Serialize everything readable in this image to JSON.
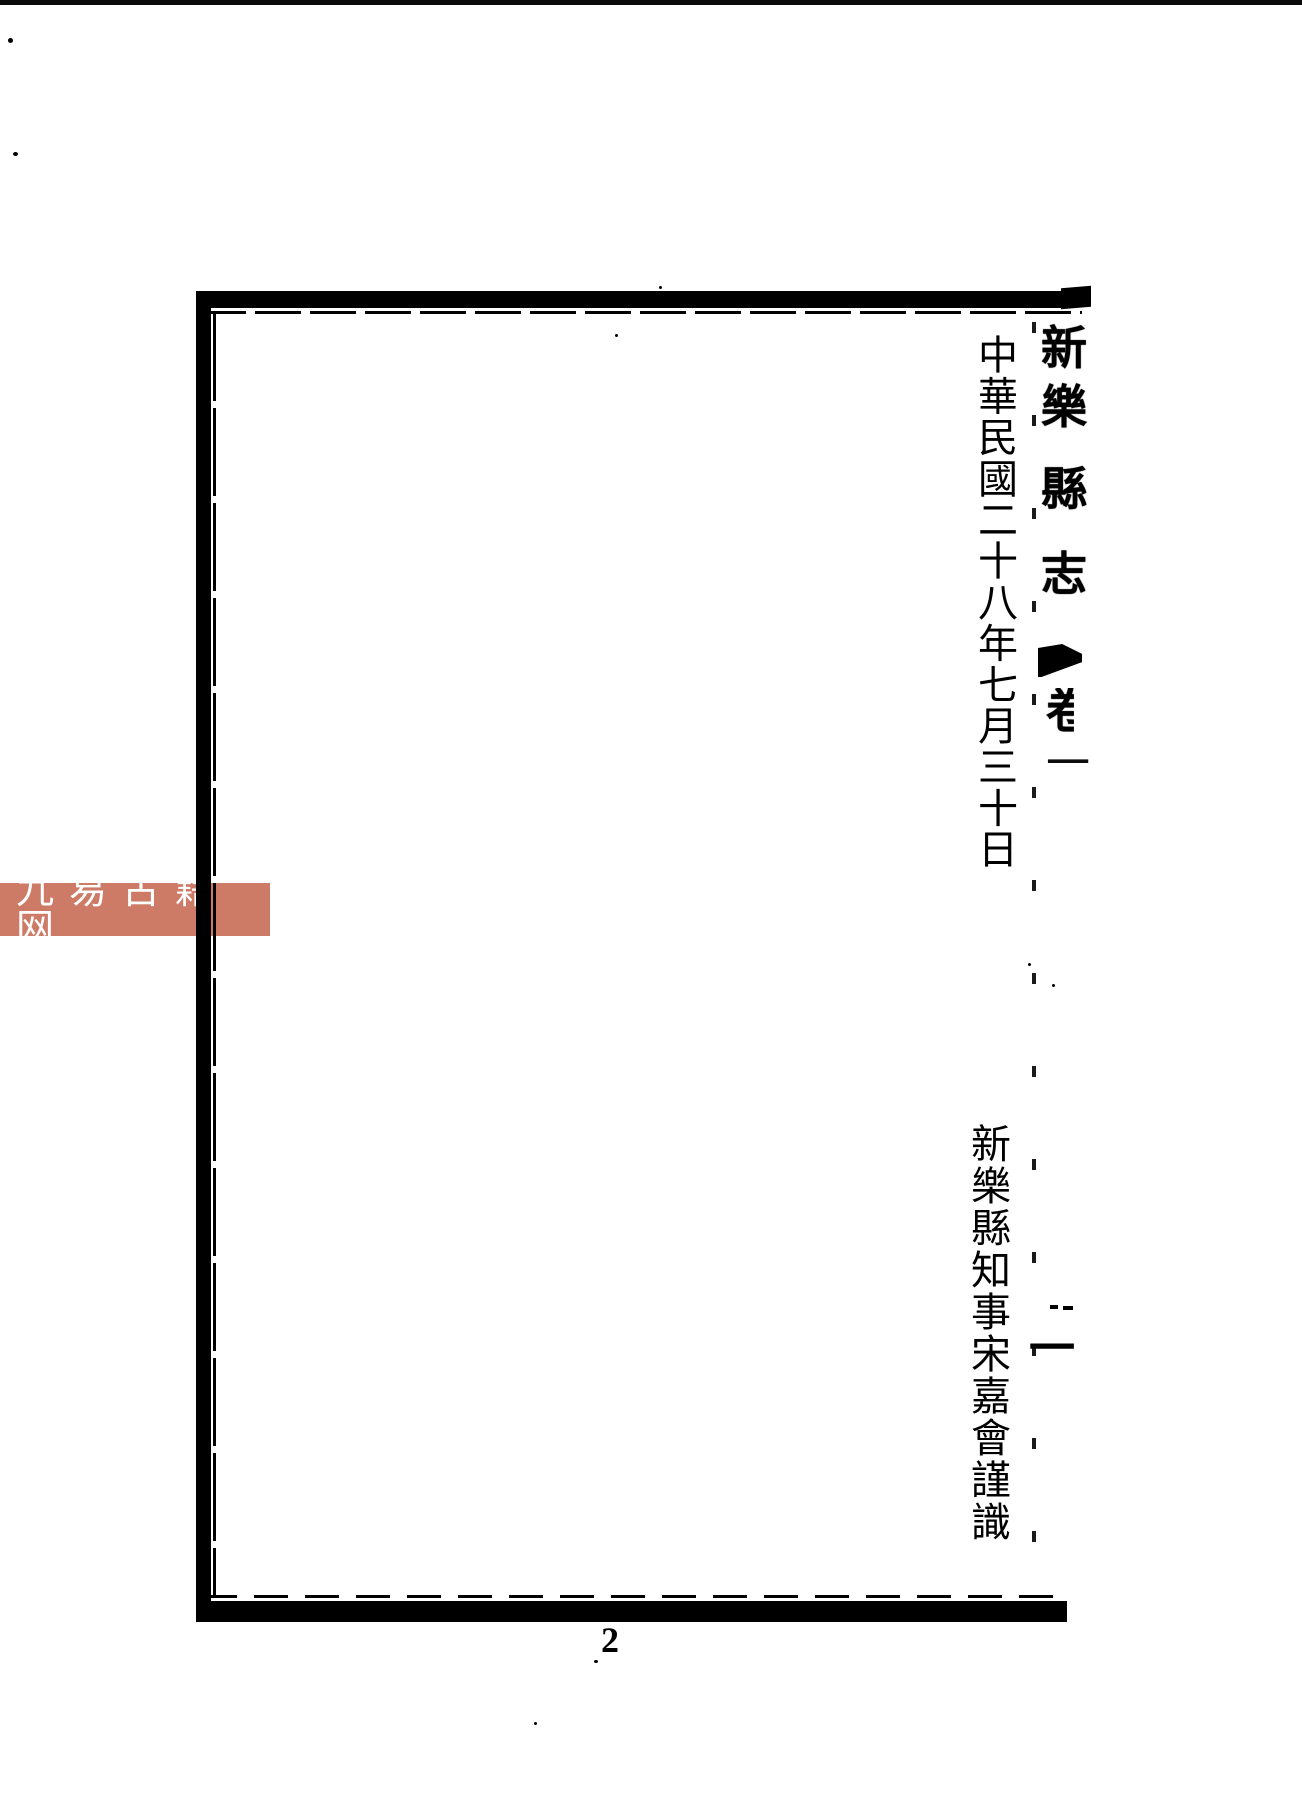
{
  "colors": {
    "ink": "#000000",
    "paper": "#ffffff",
    "watermark_band": "#cd7b67",
    "watermark_text": "#ffffff"
  },
  "fold_column": {
    "title": [
      "新",
      "樂",
      "縣",
      "志"
    ],
    "marker_icon": "fish-tail-fold-marker",
    "volume_label": "卷",
    "volume_number": "一",
    "folio_number": "一"
  },
  "content": {
    "date_line": "中華民國二十八年七月三十日",
    "signature_line": "新樂縣知事宋嘉會謹識"
  },
  "footer": {
    "page_number": "2"
  },
  "watermark": {
    "text": "九易古籍网"
  }
}
